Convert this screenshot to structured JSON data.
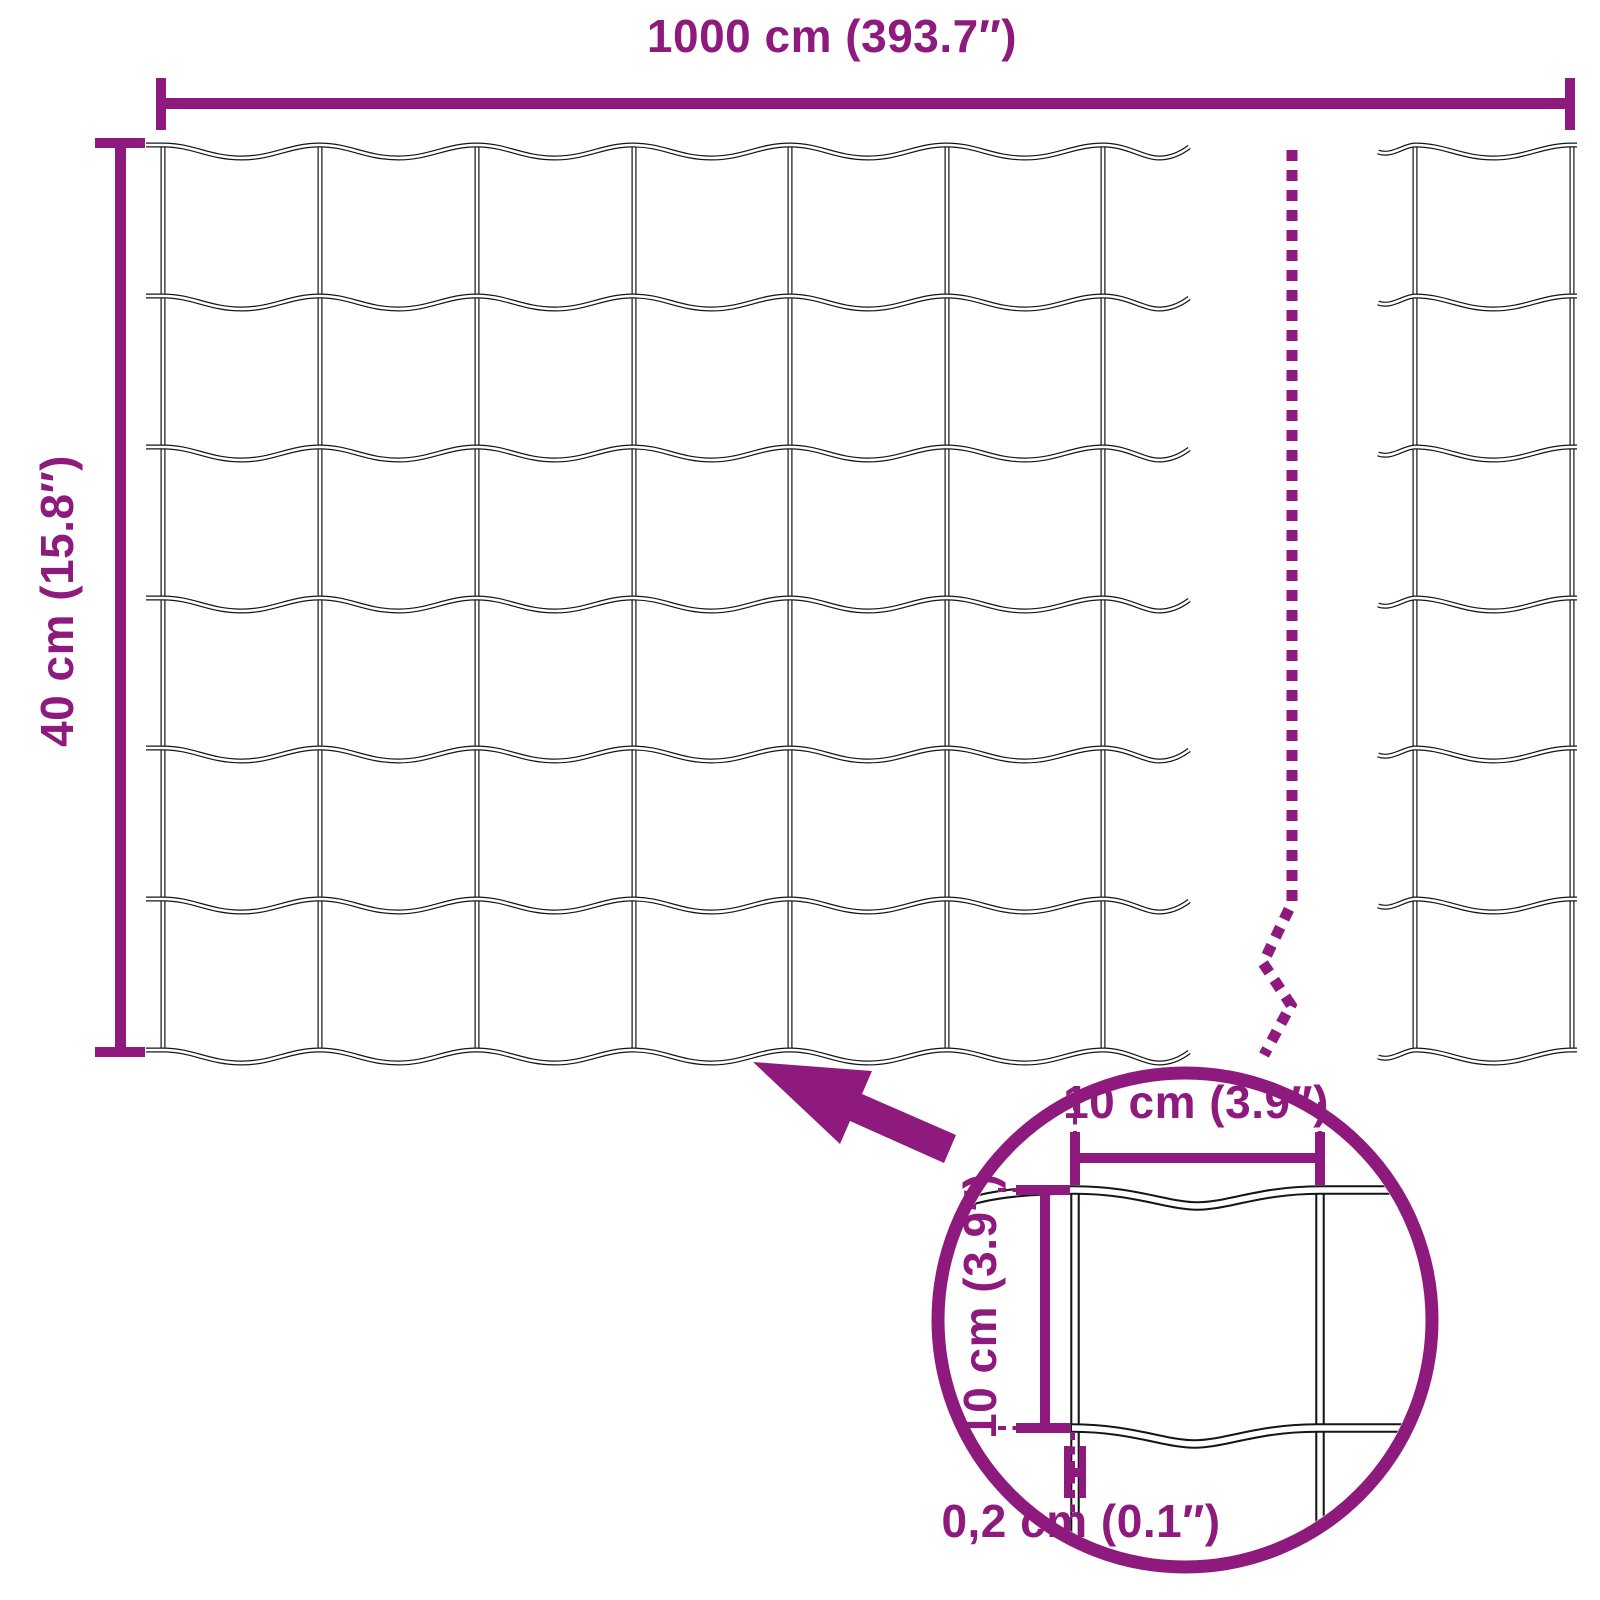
{
  "diagram": {
    "dimensions": {
      "total_width": "1000 cm (393.7″)",
      "total_height": "40 cm (15.8″)"
    },
    "zoom_detail": {
      "cell_width": "10 cm (3.9″)",
      "cell_height": "10 cm (3.9″)",
      "wire_thickness": "0,2 cm (0.1″)"
    },
    "mesh": {
      "rows": 6,
      "left_section_vertical_wires": 7,
      "right_section_vertical_wires": 2
    },
    "colors": {
      "accent": "#8E1A7E",
      "wire": "#151515",
      "background": "#FFFFFF"
    }
  }
}
